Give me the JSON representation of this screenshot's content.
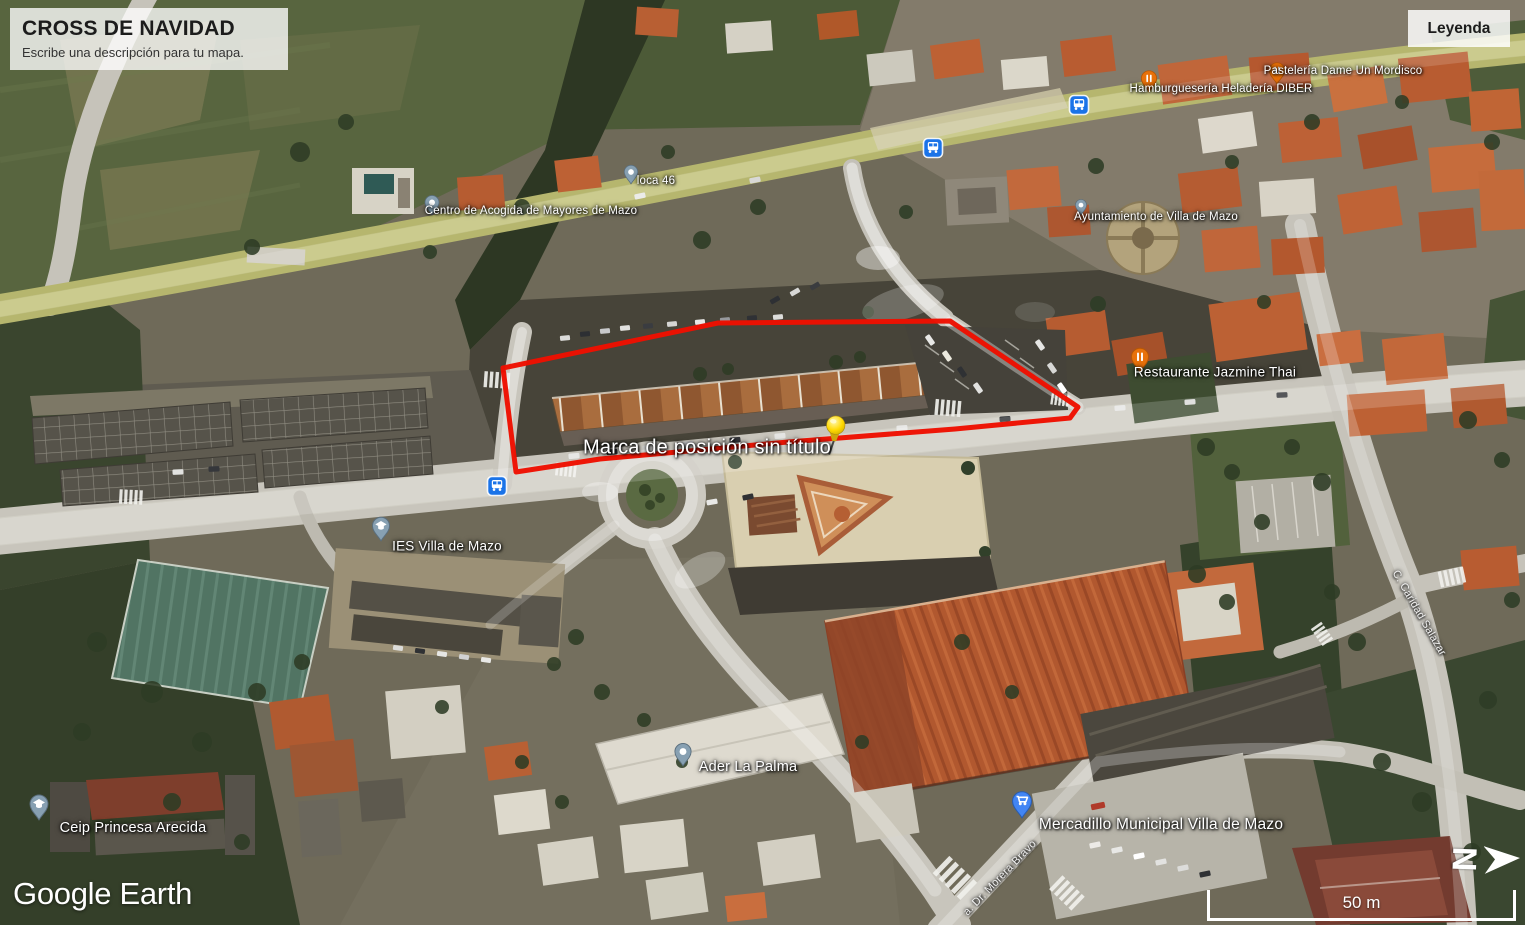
{
  "app": {
    "name": "Google Earth"
  },
  "title_panel": {
    "title": "CROSS DE NAVIDAD",
    "subtitle": "Escribe una descripción para tu mapa."
  },
  "legend": {
    "label": "Leyenda"
  },
  "watermark": {
    "text": "Google Earth"
  },
  "scale_bar": {
    "distance": "50 m"
  },
  "compass": {
    "north": "N"
  },
  "placemark": {
    "label": "Marca de posición sin título",
    "pushpin_color": "#ffd500",
    "outline_color": "#ee1000"
  },
  "place_labels": [
    {
      "text": "loca 46",
      "icon": "place-pin"
    },
    {
      "text": "Centro de Acogida de Mayores de Mazo",
      "icon": "place-pin"
    },
    {
      "text": "Hamburguesería Heladería DIBER",
      "icon": "food-pin"
    },
    {
      "text": "Pastelería Dame Un Mordisco",
      "icon": "food-pin"
    },
    {
      "text": "Ayuntamiento de Villa de Mazo",
      "icon": "place-pin"
    },
    {
      "text": "Restaurante Jazmine Thai",
      "icon": "food-pin"
    },
    {
      "text": "IES Villa de Mazo",
      "icon": "school-pin"
    },
    {
      "text": "Ceip Princesa Arecida",
      "icon": "school-pin"
    },
    {
      "text": "Ader La Palma",
      "icon": "place-pin"
    },
    {
      "text": "Mercadillo Municipal Villa de Mazo",
      "icon": "shopping-pin"
    }
  ],
  "street_labels": [
    {
      "text": "C. Caridad Salazar"
    },
    {
      "text": "a. Dr. Morera Bravo"
    }
  ],
  "transit": {
    "bus_stop_count": 3
  },
  "colors": {
    "polygon_outline": "#ee1000",
    "pushpin": "#ffd500",
    "food_pin": "#e8710a",
    "shopping_pin": "#4285f4",
    "place_pin": "#87a0b2",
    "bus_icon": "#1a73e8"
  }
}
